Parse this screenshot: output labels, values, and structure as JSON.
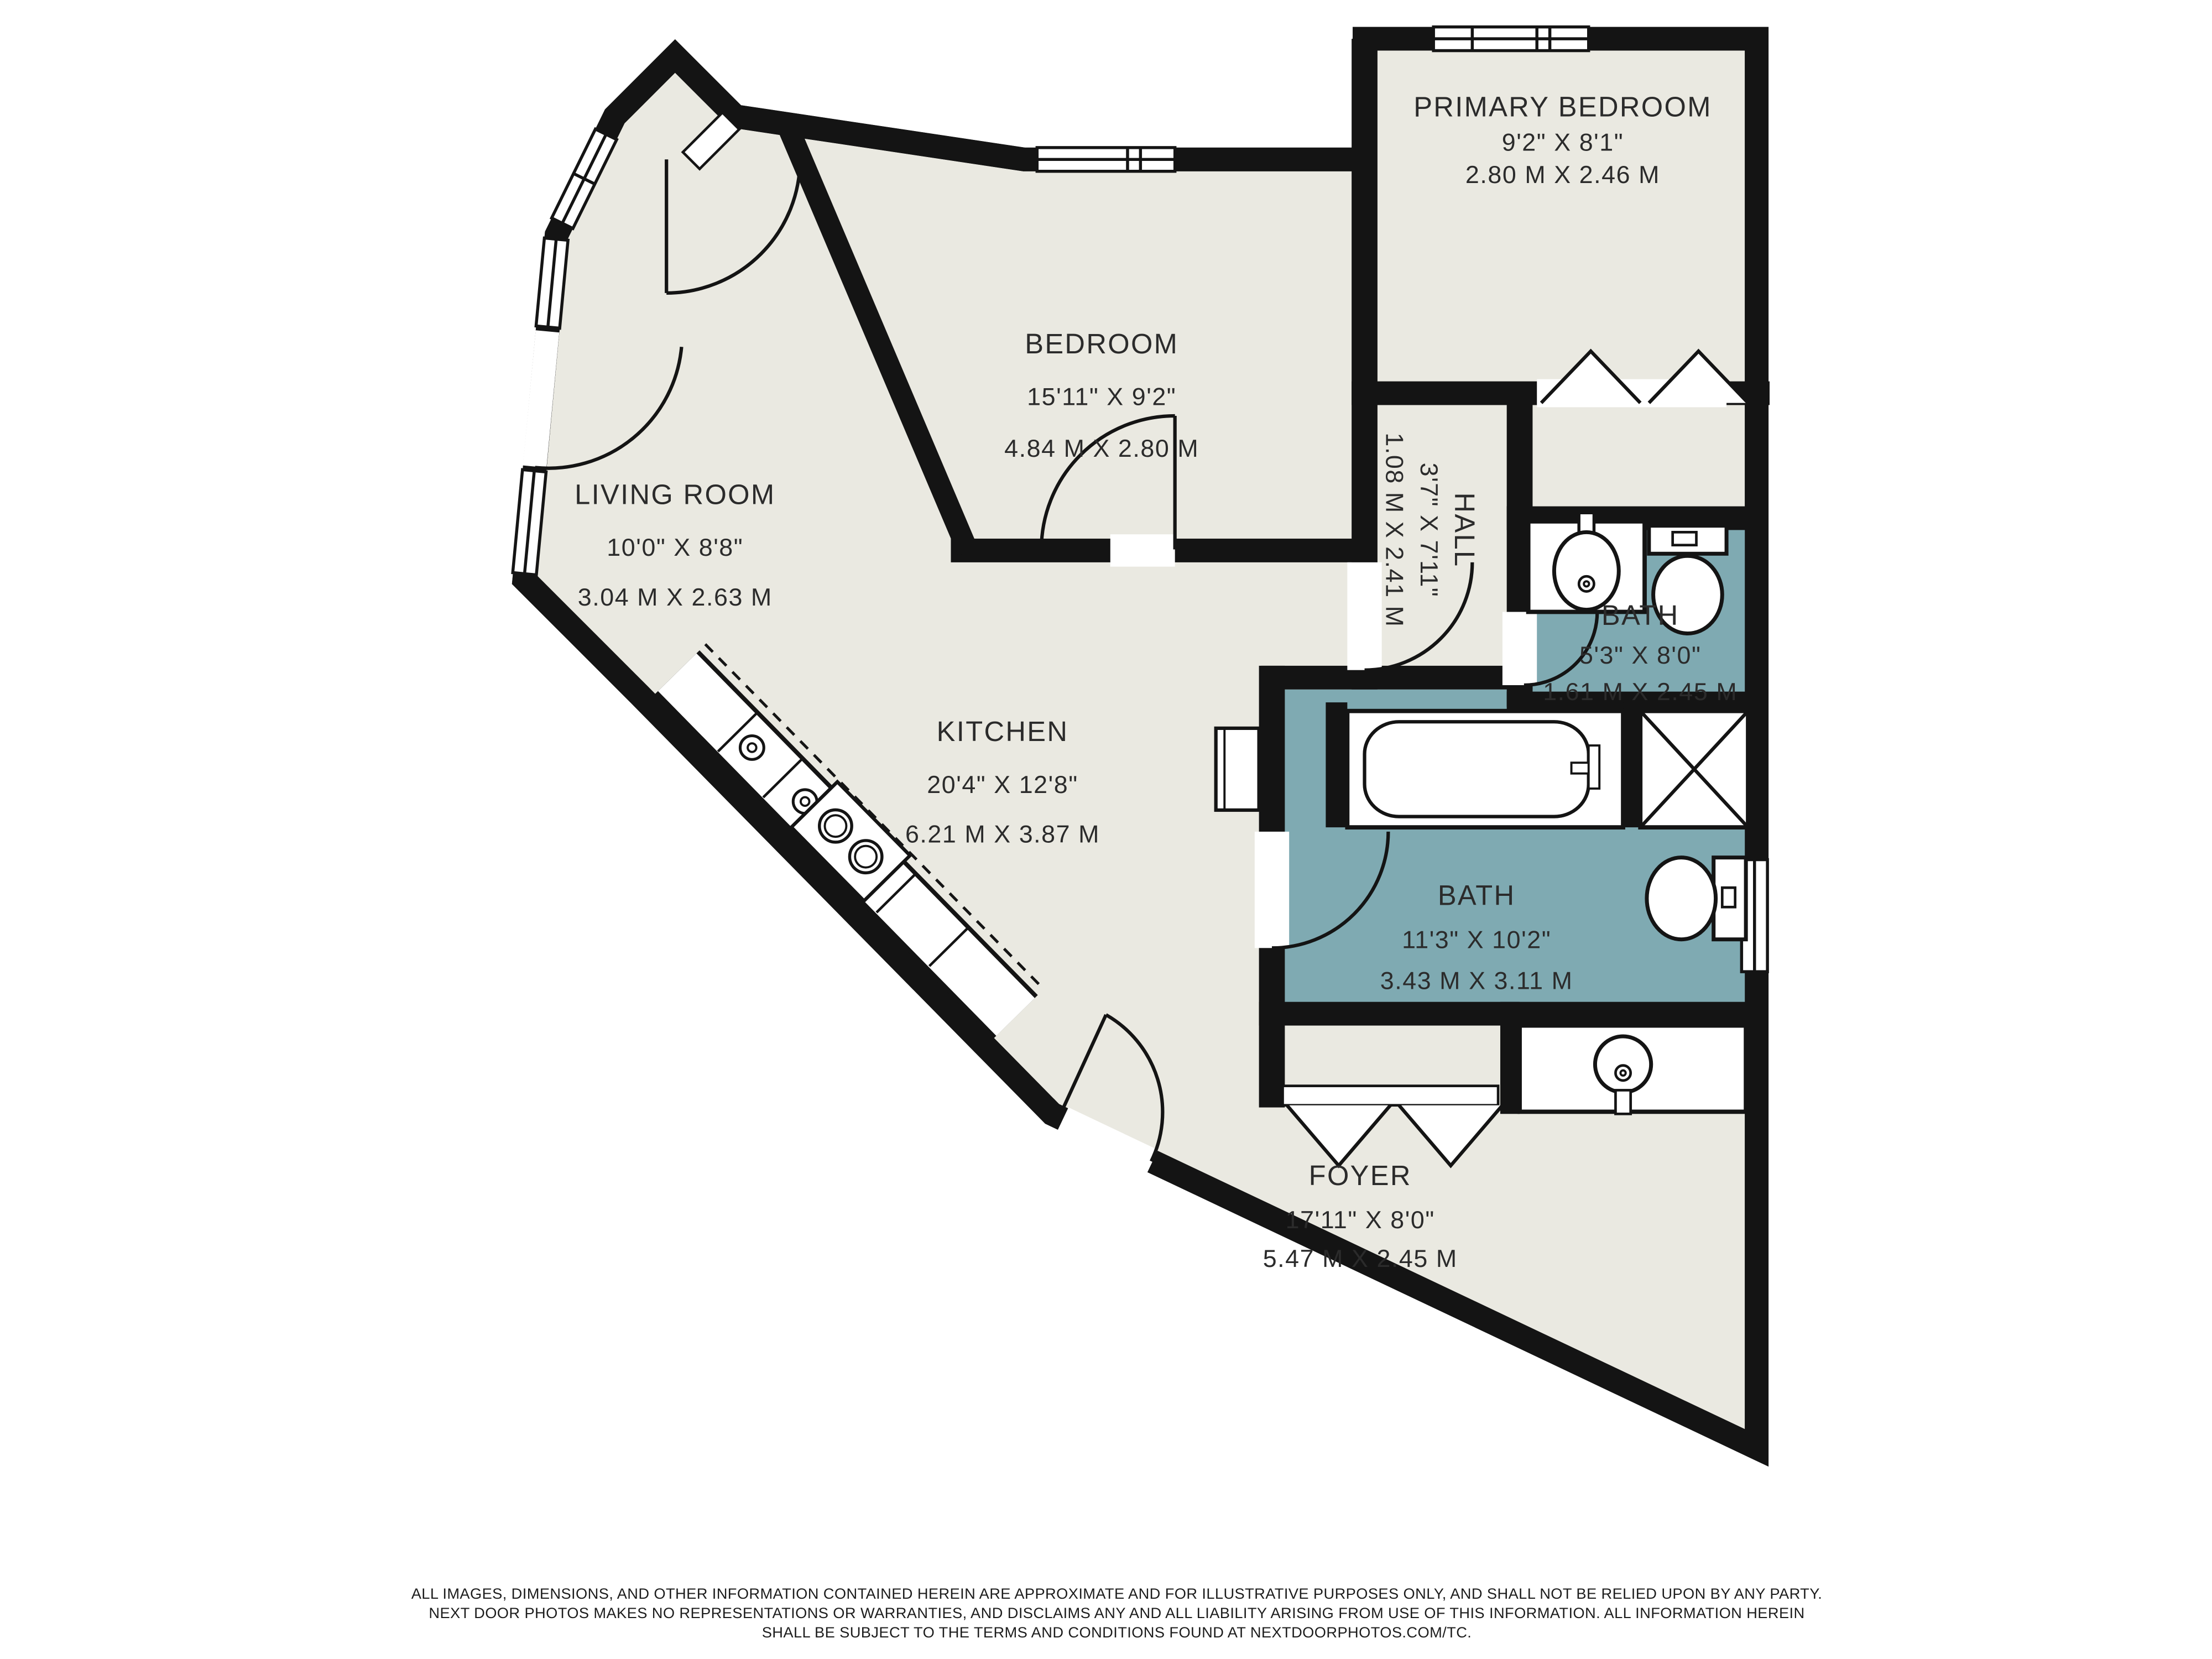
{
  "floor_plan": {
    "colors": {
      "background": "#ffffff",
      "floor": "#eae9e1",
      "bath_floor": "#7faab2",
      "wall": "#141414",
      "text": "#2b2b2b"
    },
    "rooms": [
      {
        "id": "primary-bedroom",
        "name": "PRIMARY BEDROOM",
        "dims_imperial": "9'2\" X 8'1\"",
        "dims_metric": "2.80 M X 2.46 M"
      },
      {
        "id": "bedroom",
        "name": "BEDROOM",
        "dims_imperial": "15'11\" X 9'2\"",
        "dims_metric": "4.84 M X 2.80 M"
      },
      {
        "id": "living-room",
        "name": "LIVING ROOM",
        "dims_imperial": "10'0\" X 8'8\"",
        "dims_metric": "3.04 M X 2.63 M"
      },
      {
        "id": "hall",
        "name": "HALL",
        "dims_imperial": "3'7\" X 7'11\"",
        "dims_metric": "1.08 M X 2.41 M"
      },
      {
        "id": "bath-upper",
        "name": "BATH",
        "dims_imperial": "5'3\" X 8'0\"",
        "dims_metric": "1.61 M X 2.45 M"
      },
      {
        "id": "kitchen",
        "name": "KITCHEN",
        "dims_imperial": "20'4\" X 12'8\"",
        "dims_metric": "6.21 M X 3.87 M"
      },
      {
        "id": "bath-lower",
        "name": "BATH",
        "dims_imperial": "11'3\" X 10'2\"",
        "dims_metric": "3.43 M X 3.11 M"
      },
      {
        "id": "foyer",
        "name": "FOYER",
        "dims_imperial": "17'11\" X 8'0\"",
        "dims_metric": "5.47 M X 2.45 M"
      }
    ],
    "disclaimer": {
      "line1": "ALL IMAGES, DIMENSIONS, AND OTHER INFORMATION CONTAINED HEREIN ARE APPROXIMATE AND FOR ILLUSTRATIVE PURPOSES ONLY, AND SHALL NOT BE RELIED UPON BY ANY PARTY.",
      "line2": "NEXT DOOR PHOTOS MAKES NO REPRESENTATIONS OR WARRANTIES, AND DISCLAIMS ANY AND ALL LIABILITY ARISING FROM USE OF THIS INFORMATION. ALL INFORMATION HEREIN",
      "line3": "SHALL BE SUBJECT TO THE TERMS AND CONDITIONS FOUND AT NEXTDOORPHOTOS.COM/TC."
    }
  }
}
